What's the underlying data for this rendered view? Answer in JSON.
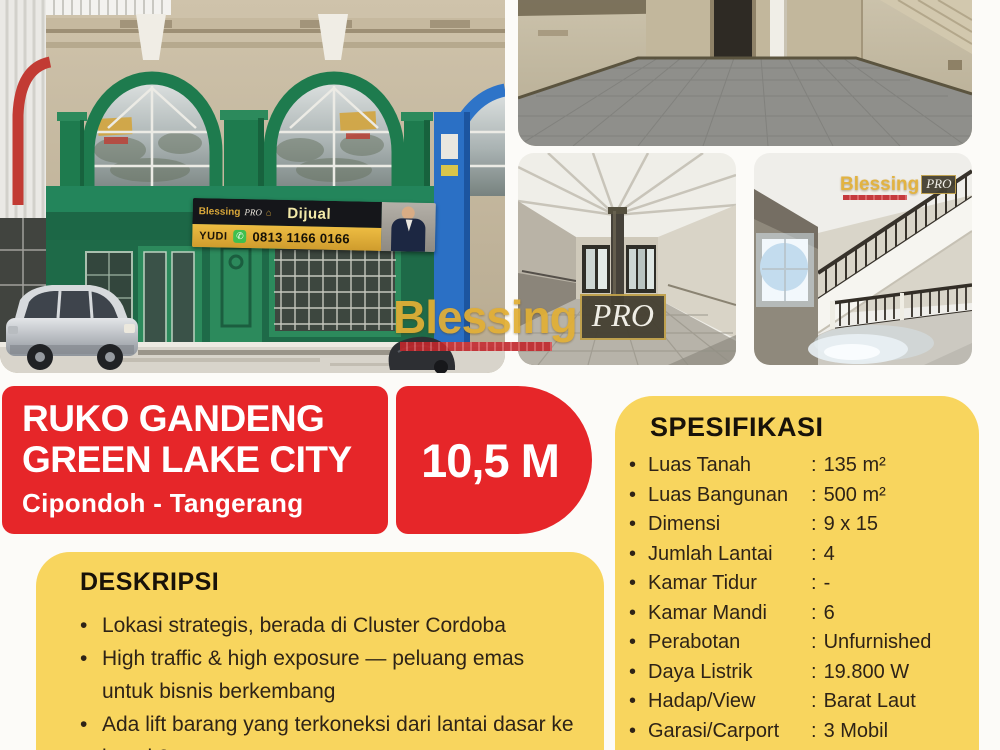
{
  "colors": {
    "red": "#e62629",
    "yellow": "#f8d55e",
    "gold": "#e2af35"
  },
  "brand": {
    "name": "Blessing",
    "suffix": "PRO"
  },
  "icons": {
    "whatsapp": "✆",
    "house": "⌂"
  },
  "banner": {
    "status_label": "Dijual",
    "agent_name": "YUDI",
    "phone": "0813 1166 0166"
  },
  "title_card": {
    "line1": "RUKO GANDENG",
    "line2": "GREEN LAKE CITY",
    "location": "Cipondoh - Tangerang"
  },
  "price": {
    "amount": "10,5 M"
  },
  "deskripsi": {
    "heading": "DESKRIPSI",
    "bullet_glyph": "•",
    "items": [
      "Lokasi strategis, berada di Cluster Cordoba",
      "High traffic & high exposure — peluang emas untuk bisnis berkembang",
      "Ada lift barang yang terkoneksi dari lantai dasar ke lantai 3"
    ]
  },
  "spesifikasi": {
    "heading": "SPESIFIKASI",
    "bullet_glyph": "•",
    "separator": ":",
    "rows": [
      {
        "label": "Luas Tanah",
        "value": "135 m²"
      },
      {
        "label": "Luas Bangunan",
        "value": "500 m²"
      },
      {
        "label": "Dimensi",
        "value": "9 x 15"
      },
      {
        "label": "Jumlah Lantai",
        "value": "4"
      },
      {
        "label": "Kamar Tidur",
        "value": "-"
      },
      {
        "label": "Kamar Mandi",
        "value": "6"
      },
      {
        "label": "Perabotan",
        "value": "Unfurnished"
      },
      {
        "label": "Daya Listrik",
        "value": "19.800 W"
      },
      {
        "label": "Hadap/View",
        "value": "Barat Laut"
      },
      {
        "label": "Garasi/Carport",
        "value": "3 Mobil"
      }
    ]
  }
}
